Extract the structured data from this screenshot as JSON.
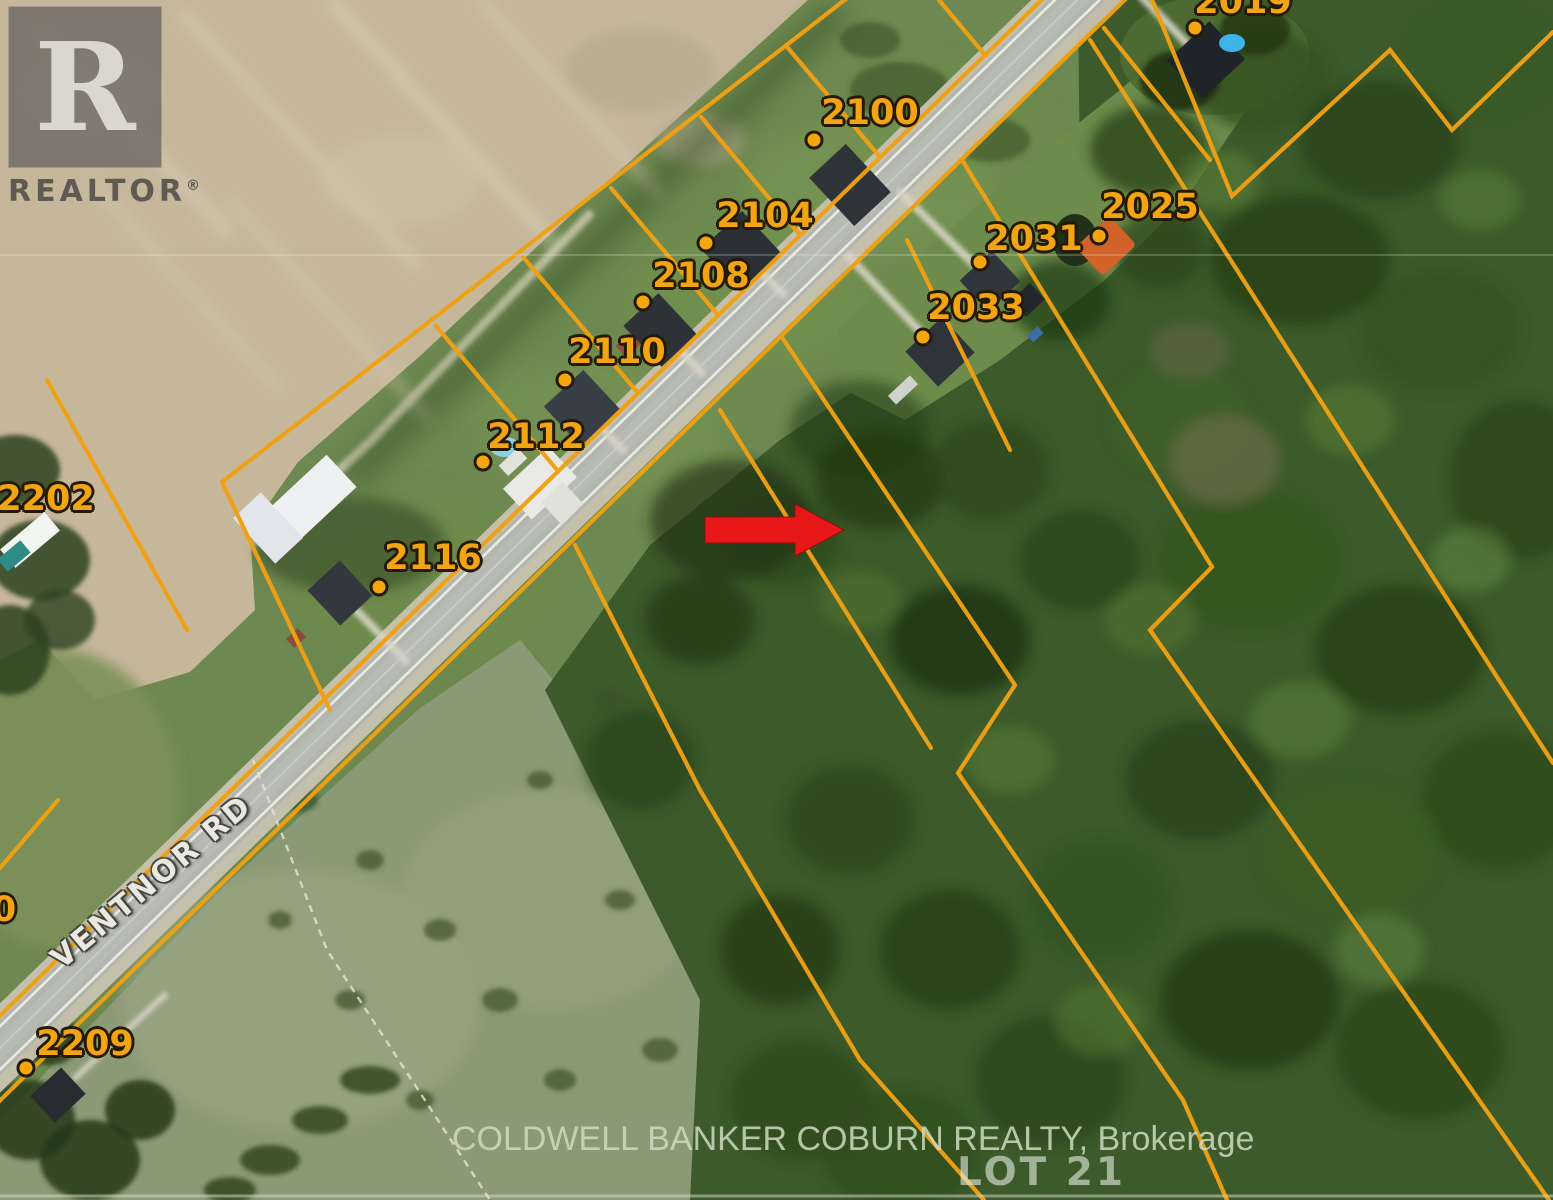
{
  "map": {
    "type": "aerial-parcel-map",
    "road_label": "VENTNOR RD",
    "lot_label": "LOT 21",
    "parcel_labels": [
      {
        "id": "2100",
        "text": "2100"
      },
      {
        "id": "2104",
        "text": "2104"
      },
      {
        "id": "2108",
        "text": "2108"
      },
      {
        "id": "2110",
        "text": "2110"
      },
      {
        "id": "2112",
        "text": "2112"
      },
      {
        "id": "2116",
        "text": "2116"
      },
      {
        "id": "2202",
        "text": "2202"
      },
      {
        "id": "2209",
        "text": "2209"
      },
      {
        "id": "partial-left",
        "text": "0"
      },
      {
        "id": "2033",
        "text": "2033"
      },
      {
        "id": "2031",
        "text": "2031"
      },
      {
        "id": "2025",
        "text": "2025"
      },
      {
        "id": "2019",
        "text": "2019"
      }
    ]
  },
  "watermarks": {
    "realtor_letter": "R",
    "realtor_text": "REALTOR",
    "registered_mark": "®",
    "brokerage": "COLDWELL BANKER COBURN REALTY, Brokerage"
  },
  "colors": {
    "parcel_line": "#f0a013",
    "parcel_label": "#f2a413",
    "marker_dot": "#f6a60d",
    "arrow_red": "#e81717",
    "road_pavement": "#b3b5af",
    "road_name_text": "#e9e9e1",
    "lot_text": "#e8eee4",
    "brokerage_text": "#cedac2"
  }
}
